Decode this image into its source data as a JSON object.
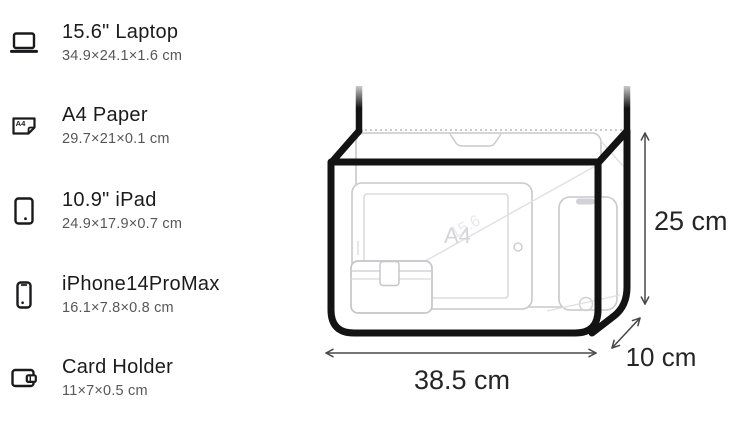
{
  "page": {
    "background": "#ffffff"
  },
  "item_list": {
    "items": [
      {
        "icon": "laptop-icon",
        "name": "15.6\" Laptop",
        "dimensions": "34.9×24.1×1.6 cm"
      },
      {
        "icon": "a4-paper-icon",
        "name": "A4 Paper",
        "dimensions": "29.7×21×0.1 cm",
        "icon_label": "A4"
      },
      {
        "icon": "ipad-icon",
        "name": "10.9\" iPad",
        "dimensions": "24.9×17.9×0.7 cm"
      },
      {
        "icon": "iphone-icon",
        "name": "iPhone14ProMax",
        "dimensions": "16.1×7.8×0.8 cm"
      },
      {
        "icon": "card-holder-icon",
        "name": "Card Holder",
        "dimensions": "11×7×0.5 cm"
      }
    ]
  },
  "bag_diagram": {
    "height_label": "25 cm",
    "width_label": "38.5 cm",
    "depth_label": "10 cm",
    "watermarks": {
      "paper": "A4",
      "laptop": "15.6"
    },
    "colors": {
      "outline": "#131314",
      "item_stroke": "#c8c8cd",
      "dotted_stitch": "#b8b8bc",
      "arrow": "#48484a",
      "dimension_text": "#252527",
      "watermark": "#d6d6da"
    }
  }
}
